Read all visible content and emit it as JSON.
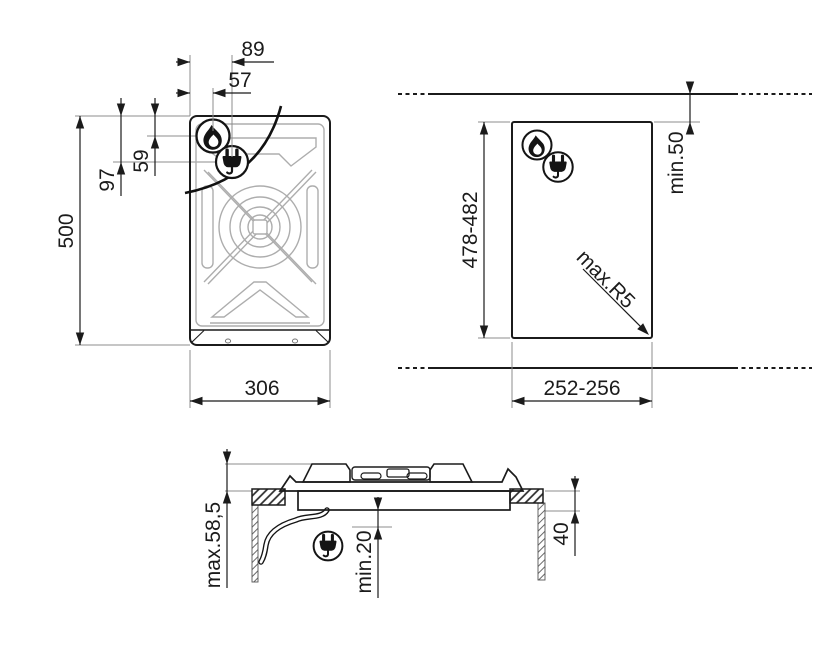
{
  "document": {
    "kind": "hob-installation-technical-drawing",
    "background": "#ffffff"
  },
  "labels": {
    "top_view": {
      "plug_offset_x": "89",
      "burner_offset_x": "57",
      "burner_offset_y": "59",
      "plug_offset_y": "97",
      "overall_depth": "500",
      "overall_width": "306"
    },
    "cutout_view": {
      "rear_clearance": "min.50",
      "cutout_depth": "478-482",
      "corner_radius": "max.R5",
      "cutout_width": "252-256"
    },
    "side_view": {
      "height_above_worktop": "max.58,5",
      "clearance_below": "min.20",
      "worktop_thickness": "40"
    }
  },
  "icons": {
    "flame": "gas-burner-icon",
    "plug": "power-plug-icon"
  },
  "colors": {
    "line": "#1b1b1b",
    "pattern": "#adadad",
    "extension_line": "#8c8c8c",
    "background": "#ffffff"
  }
}
